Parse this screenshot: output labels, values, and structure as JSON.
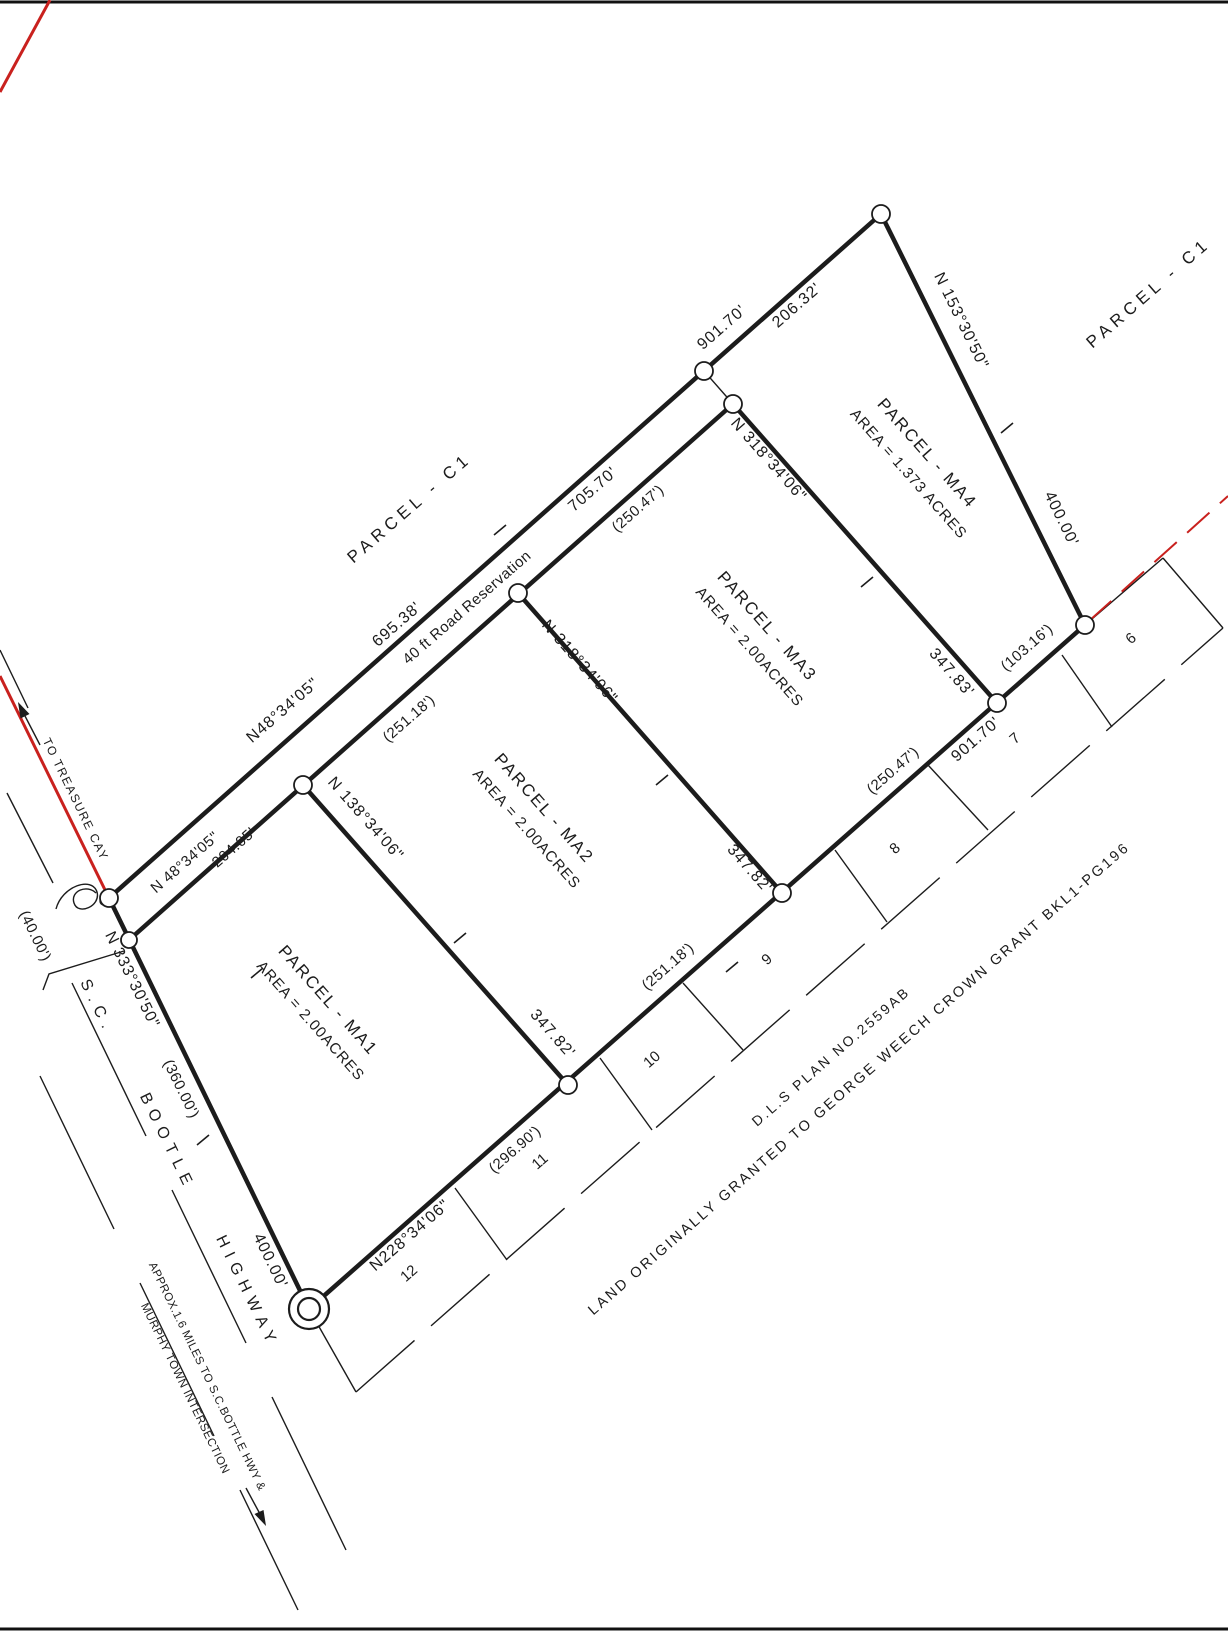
{
  "colors": {
    "ink": "#1c1c1c",
    "red": "#c9211e"
  },
  "parcels": [
    {
      "name": "PARCEL - MA1",
      "area": "AREA = 2.00ACRES"
    },
    {
      "name": "PARCEL - MA2",
      "area": "AREA = 2.00ACRES"
    },
    {
      "name": "PARCEL - MA3",
      "area": "AREA = 2.00ACRES"
    },
    {
      "name": "PARCEL - MA4",
      "area": "AREA = 1.373 ACRES"
    }
  ],
  "adjacent_parcel": "PARCEL - C1",
  "road_reservation": "40 ft Road Reservation",
  "highway_name": "S.C. BOOTLE HIGHWAY",
  "lot_numbers": [
    "6",
    "7",
    "8",
    "9",
    "10",
    "11",
    "12"
  ],
  "texts": [
    {
      "n": "parcel-c1-left-label",
      "t": "PARCEL - C1",
      "x": 413,
      "y": 512,
      "r": -41,
      "s": 17,
      "ls": 5
    },
    {
      "n": "parcel-c1-right-label",
      "t": "PARCEL - C1",
      "x": 1152,
      "y": 297,
      "r": -41,
      "s": 17,
      "ls": 5
    },
    {
      "n": "parcel-ma4-name",
      "t": "PARCEL - MA4",
      "x": 923,
      "y": 457,
      "r": 48.5,
      "s": 17,
      "ls": 2
    },
    {
      "n": "parcel-ma4-area",
      "t": "AREA = 1.373 ACRES",
      "x": 905,
      "y": 477,
      "r": 48.5,
      "s": 15,
      "ls": 1
    },
    {
      "n": "parcel-ma3-name",
      "t": "PARCEL - MA3",
      "x": 763,
      "y": 630,
      "r": 48.5,
      "s": 17,
      "ls": 2
    },
    {
      "n": "parcel-ma3-area",
      "t": "AREA = 2.00ACRES",
      "x": 746,
      "y": 650,
      "r": 48.5,
      "s": 15,
      "ls": 1
    },
    {
      "n": "parcel-ma2-name",
      "t": "PARCEL - MA2",
      "x": 540,
      "y": 812,
      "r": 48.5,
      "s": 17,
      "ls": 2
    },
    {
      "n": "parcel-ma2-area",
      "t": "AREA = 2.00ACRES",
      "x": 523,
      "y": 832,
      "r": 48.5,
      "s": 15,
      "ls": 1
    },
    {
      "n": "parcel-ma1-name",
      "t": "PARCEL - MA1",
      "x": 324,
      "y": 1004,
      "r": 48.5,
      "s": 17,
      "ls": 2
    },
    {
      "n": "parcel-ma1-area",
      "t": "AREA = 2.00ACRES",
      "x": 307,
      "y": 1024,
      "r": 48.5,
      "s": 15,
      "ls": 1
    },
    {
      "n": "dim-901-70-top",
      "t": "901.70'",
      "x": 725,
      "y": 331,
      "r": -41,
      "s": 16,
      "ls": 1
    },
    {
      "n": "dim-206-32",
      "t": "206.32'",
      "x": 800,
      "y": 309,
      "r": -41,
      "s": 16,
      "ls": 1
    },
    {
      "n": "bearing-153-30-50",
      "t": "N 153°30'50\"",
      "x": 957,
      "y": 323,
      "r": 64,
      "s": 16,
      "ls": 1
    },
    {
      "n": "dim-400-00-right",
      "t": "400.00'",
      "x": 1057,
      "y": 521,
      "r": 64,
      "s": 16,
      "ls": 1
    },
    {
      "n": "dim-695-38",
      "t": "695.38'",
      "x": 400,
      "y": 628,
      "r": -41,
      "s": 16,
      "ls": 1
    },
    {
      "n": "bearing-48-34-05-upper",
      "t": "N48°34'05\"",
      "x": 286,
      "y": 714,
      "r": -41,
      "s": 16,
      "ls": 1
    },
    {
      "n": "road-reservation-label",
      "t": "40 ft Road Reservation",
      "x": 470,
      "y": 611,
      "r": -41,
      "s": 15,
      "ls": 0.5
    },
    {
      "n": "dim-705-70",
      "t": "705.70'",
      "x": 596,
      "y": 493,
      "r": -41,
      "s": 16,
      "ls": 1
    },
    {
      "n": "dim-250-47-top",
      "t": "(250.47')",
      "x": 641,
      "y": 512,
      "r": -41,
      "s": 15,
      "ls": 0.5
    },
    {
      "n": "dim-251-18-top",
      "t": "(251.18')",
      "x": 412,
      "y": 722,
      "r": -41,
      "s": 15,
      "ls": 0.5
    },
    {
      "n": "bearing-48-34-05-lower",
      "t": "N 48°34'05\"",
      "x": 188,
      "y": 866,
      "r": -41,
      "s": 15,
      "ls": 0.5
    },
    {
      "n": "dim-204-05",
      "t": "204.05'",
      "x": 237,
      "y": 851,
      "r": -41,
      "s": 15,
      "ls": 0.5
    },
    {
      "n": "bearing-318-34-06-a",
      "t": "N 318°34'06\"",
      "x": 765,
      "y": 463,
      "r": 48.5,
      "s": 16,
      "ls": 1
    },
    {
      "n": "bearing-318-34-06-b",
      "t": "N 318°34'06\"",
      "x": 576,
      "y": 665,
      "r": 48.5,
      "s": 16,
      "ls": 1
    },
    {
      "n": "bearing-138-34-06",
      "t": "N 138°34'06\"",
      "x": 362,
      "y": 822,
      "r": 48.5,
      "s": 16,
      "ls": 1
    },
    {
      "n": "dim-347-83",
      "t": "347.83'",
      "x": 948,
      "y": 676,
      "r": 48.5,
      "s": 16,
      "ls": 1
    },
    {
      "n": "dim-347-82-a",
      "t": "347.82'",
      "x": 746,
      "y": 872,
      "r": 48.5,
      "s": 16,
      "ls": 1
    },
    {
      "n": "dim-347-82-b",
      "t": "347.82'",
      "x": 549,
      "y": 1037,
      "r": 48.5,
      "s": 16,
      "ls": 1
    },
    {
      "n": "dim-103-16",
      "t": "(103.16')",
      "x": 1030,
      "y": 651,
      "r": -41,
      "s": 15,
      "ls": 0.5
    },
    {
      "n": "dim-901-70-south",
      "t": "901.70'",
      "x": 979,
      "y": 743,
      "r": -41,
      "s": 16,
      "ls": 1
    },
    {
      "n": "dim-250-47-south",
      "t": "(250.47')",
      "x": 896,
      "y": 774,
      "r": -41,
      "s": 15,
      "ls": 0.5
    },
    {
      "n": "dim-251-18-south",
      "t": "(251.18')",
      "x": 671,
      "y": 970,
      "r": -41,
      "s": 15,
      "ls": 0.5
    },
    {
      "n": "dim-296-90",
      "t": "(296.90')",
      "x": 518,
      "y": 1153,
      "r": -41,
      "s": 15,
      "ls": 0.5
    },
    {
      "n": "bearing-228-34-06",
      "t": "N228°34'06\"",
      "x": 413,
      "y": 1239,
      "r": -41,
      "s": 16,
      "ls": 1
    },
    {
      "n": "lot-number-6",
      "t": "6",
      "x": 1134,
      "y": 642,
      "r": -41,
      "s": 15,
      "ls": 0
    },
    {
      "n": "lot-number-7",
      "t": "7",
      "x": 1018,
      "y": 742,
      "r": -41,
      "s": 15,
      "ls": 0
    },
    {
      "n": "lot-number-8",
      "t": "8",
      "x": 898,
      "y": 852,
      "r": -41,
      "s": 15,
      "ls": 0
    },
    {
      "n": "lot-number-9",
      "t": "9",
      "x": 770,
      "y": 963,
      "r": -41,
      "s": 15,
      "ls": 0
    },
    {
      "n": "lot-number-10",
      "t": "10",
      "x": 655,
      "y": 1063,
      "r": -41,
      "s": 15,
      "ls": 0
    },
    {
      "n": "lot-number-11",
      "t": "11",
      "x": 543,
      "y": 1165,
      "r": -41,
      "s": 15,
      "ls": 0
    },
    {
      "n": "lot-number-12",
      "t": "12",
      "x": 412,
      "y": 1277,
      "r": -41,
      "s": 15,
      "ls": 0
    },
    {
      "n": "dls-plan-number",
      "t": "D.L.S PLAN NO.2559AB",
      "x": 834,
      "y": 1060,
      "r": -41,
      "s": 14,
      "ls": 2.5
    },
    {
      "n": "crown-grant-note",
      "t": "LAND ORIGINALLY GRANTED TO GEORGE WEECH CROWN GRANT BKL1-PG196",
      "x": 862,
      "y": 1082,
      "r": -41,
      "s": 14.5,
      "ls": 2.5
    },
    {
      "n": "bearing-333-30-50",
      "t": "N 333°30'50\"",
      "x": 128,
      "y": 982,
      "r": 64,
      "s": 16,
      "ls": 1
    },
    {
      "n": "dim-360-00",
      "t": "(360.00')",
      "x": 177,
      "y": 1091,
      "r": 64,
      "s": 15,
      "ls": 0.5
    },
    {
      "n": "dim-40-00",
      "t": "(40.00')",
      "x": 31,
      "y": 938,
      "r": 64,
      "s": 15,
      "ls": 0.5
    },
    {
      "n": "dim-400-00-left",
      "t": "400.00'",
      "x": 266,
      "y": 1263,
      "r": 64,
      "s": 16,
      "ls": 1
    },
    {
      "n": "highway-label-sc",
      "t": "S.C.",
      "x": 93,
      "y": 1009,
      "r": 64,
      "s": 16,
      "ls": 7
    },
    {
      "n": "highway-label-bootle",
      "t": "BOOTLE",
      "x": 163,
      "y": 1144,
      "r": 64,
      "s": 16,
      "ls": 7
    },
    {
      "n": "highway-label-highway",
      "t": "HIGHWAY",
      "x": 243,
      "y": 1294,
      "r": 64,
      "s": 16,
      "ls": 7
    },
    {
      "n": "treasure-cay-label",
      "t": "TO TREASURE CAY",
      "x": 72,
      "y": 801,
      "r": 64,
      "s": 12,
      "ls": 1.5
    },
    {
      "n": "approx-distance-line1",
      "t": "APPROX.1.6 MILES TO S.C.BOTTLE HWY &",
      "x": 204,
      "y": 1378,
      "r": 64,
      "s": 11.5,
      "ls": 0.5
    },
    {
      "n": "approx-distance-line2",
      "t": "MURPHY TOWN INTERSECTION",
      "x": 182,
      "y": 1390,
      "r": 64,
      "s": 11.5,
      "ls": 0.5
    }
  ]
}
